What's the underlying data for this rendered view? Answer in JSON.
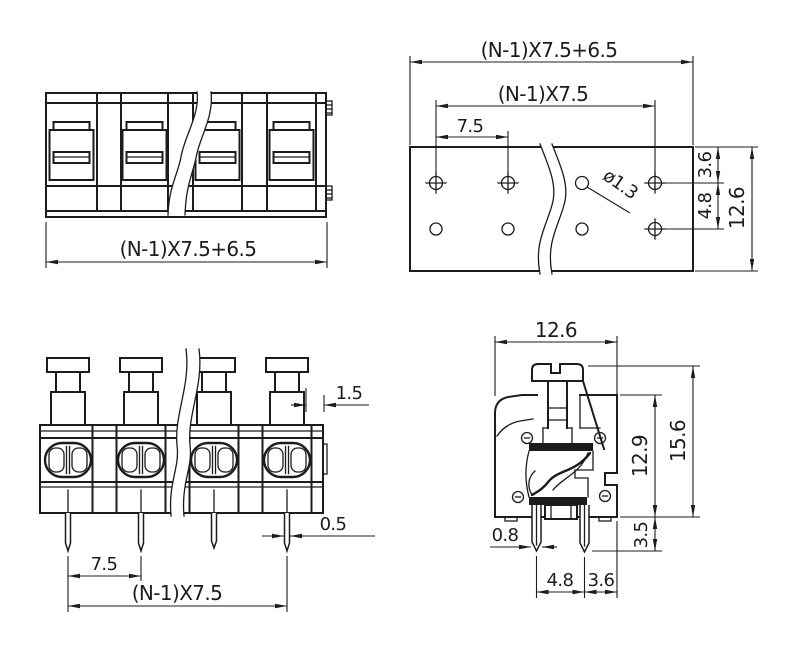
{
  "drawing": {
    "background": "#ffffff",
    "ink": "#1c1c1c"
  },
  "views": {
    "front": {
      "overall_width": "(N-1)X7.5+6.5"
    },
    "plan": {
      "overall_width": "(N-1)X7.5+6.5",
      "pin_span": "(N-1)X7.5",
      "pin_pitch": "7.5",
      "hole_diameter": "ø1.3",
      "top_row_offset": "3.6",
      "row_spacing": "4.8",
      "overall_depth": "12.6"
    },
    "front_actuated": {
      "actuator_step": "1.5",
      "pin_width": "0.5",
      "pin_pitch": "7.5",
      "pin_span": "(N-1)X7.5"
    },
    "side": {
      "overall_width": "12.6",
      "overall_height": "15.6",
      "body_height": "12.9",
      "pin_length": "3.5",
      "pin_width": "0.8",
      "pin_spacing": "4.8",
      "pin_edge_offset": "3.6"
    }
  }
}
